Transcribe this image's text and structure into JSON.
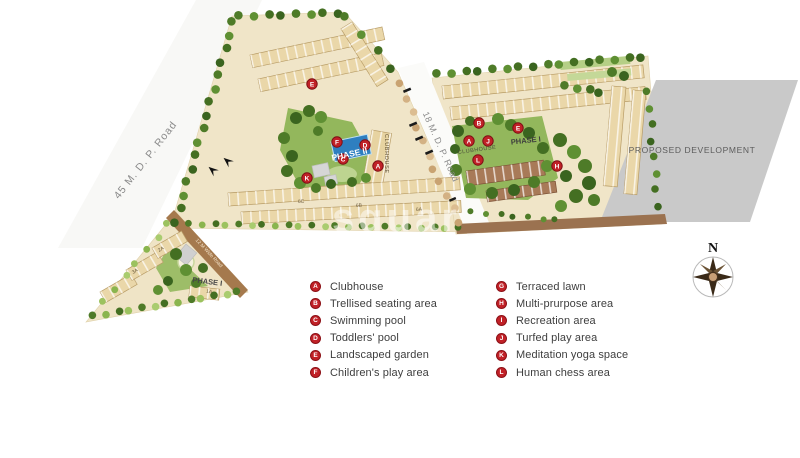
{
  "map": {
    "road_45_label": "45 M. D. P. Road",
    "road_18_label": "18 M. D. P. Road",
    "road_12_label": "12 M Wide Road",
    "proposed_label": "PROPOSED DEVELOPMENT",
    "compass_north": "N",
    "phase2_label": "PHASE II",
    "phase1_right_label": "PHASE I",
    "phase1_triangle_label": "PHASE I",
    "triangle_sub_label": "1A",
    "clubhouse_phase2": "CLUBHOUSE",
    "clubhouse_phase1": "CLUBHOUSE",
    "building_row_labels": [
      "6C",
      "6B",
      "6A"
    ],
    "triangle_building_labels": [
      "3A",
      "2A"
    ],
    "watermark": "squar",
    "colors": {
      "marker_red": "#c12127",
      "pool_blue": "#2e7fc0",
      "proposed_gray": "#c9c9c9",
      "parcel_tan": "#f0e5c8",
      "road_brown": "#9b7250"
    },
    "markers": [
      {
        "letter": "E",
        "x": 312,
        "y": 84
      },
      {
        "letter": "F",
        "x": 337,
        "y": 142
      },
      {
        "letter": "D",
        "x": 365,
        "y": 145
      },
      {
        "letter": "C",
        "x": 343,
        "y": 159
      },
      {
        "letter": "A",
        "x": 378,
        "y": 166
      },
      {
        "letter": "K",
        "x": 307,
        "y": 178
      },
      {
        "letter": "B",
        "x": 479,
        "y": 123
      },
      {
        "letter": "A",
        "x": 469,
        "y": 141
      },
      {
        "letter": "J",
        "x": 488,
        "y": 141
      },
      {
        "letter": "L",
        "x": 478,
        "y": 160
      },
      {
        "letter": "E",
        "x": 518,
        "y": 128
      },
      {
        "letter": "H",
        "x": 557,
        "y": 166
      }
    ]
  },
  "legend": {
    "columns": [
      {
        "items": [
          {
            "letter": "A",
            "label": "Clubhouse"
          },
          {
            "letter": "B",
            "label": "Trellised seating area"
          },
          {
            "letter": "C",
            "label": "Swimming pool"
          },
          {
            "letter": "D",
            "label": "Toddlers' pool"
          },
          {
            "letter": "E",
            "label": "Landscaped garden"
          },
          {
            "letter": "F",
            "label": "Children's play area"
          }
        ]
      },
      {
        "items": [
          {
            "letter": "G",
            "label": "Terraced lawn"
          },
          {
            "letter": "H",
            "label": "Multi-prurpose area"
          },
          {
            "letter": "I",
            "label": "Recreation area"
          },
          {
            "letter": "J",
            "label": "Turfed play area"
          },
          {
            "letter": "K",
            "label": "Meditation yoga space"
          },
          {
            "letter": "L",
            "label": "Human chess area"
          }
        ]
      }
    ]
  }
}
